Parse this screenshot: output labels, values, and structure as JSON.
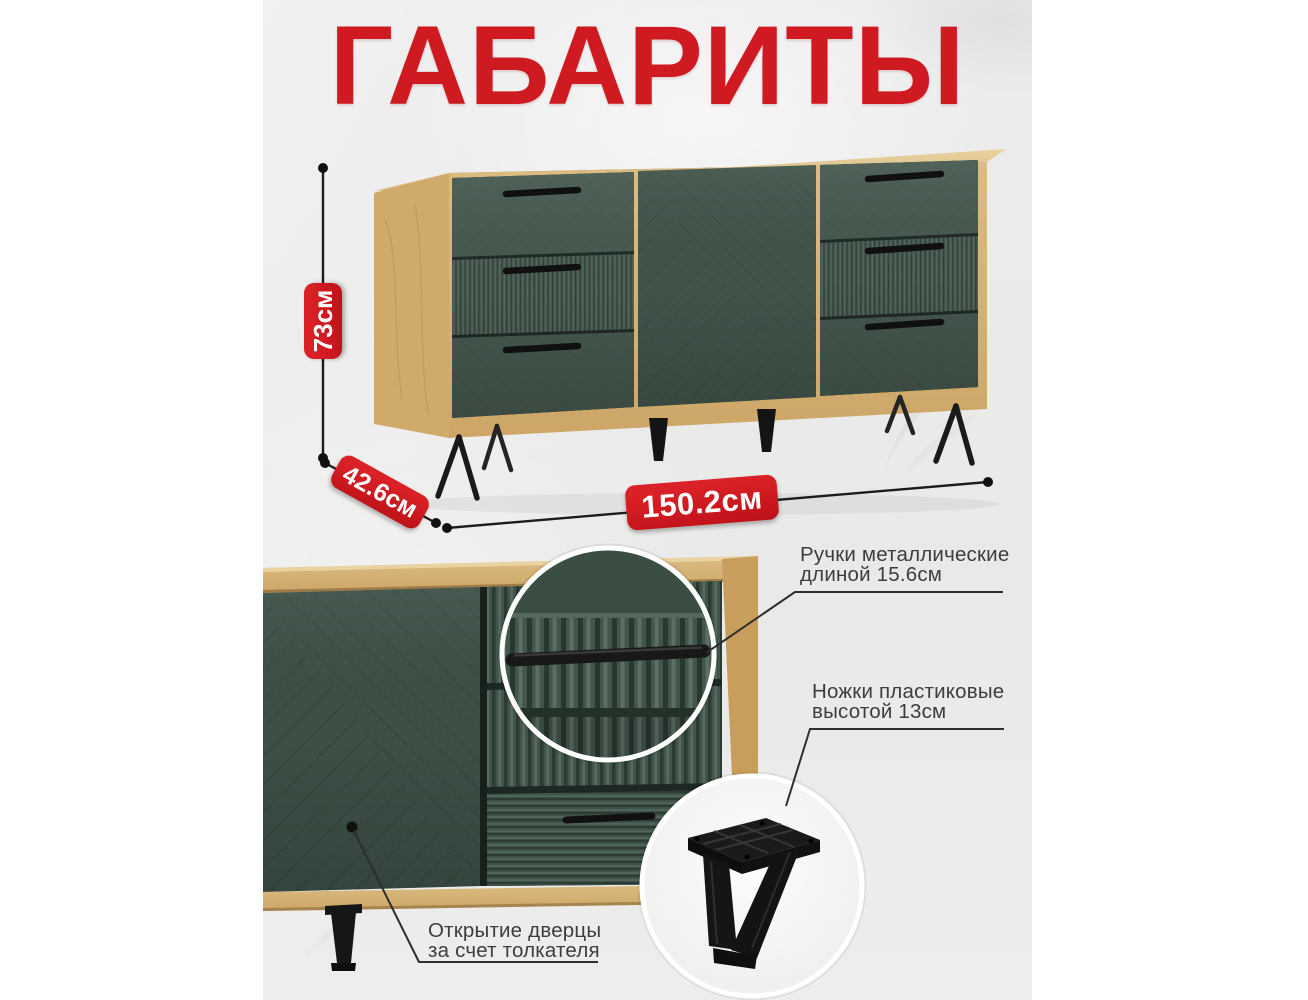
{
  "title": "ГАБАРИТЫ",
  "dimensions": {
    "height": "73см",
    "depth": "42.6см",
    "width": "150.2см"
  },
  "callouts": {
    "handles": {
      "line1": "Ручки металлические",
      "line2": "длиной 15.6см"
    },
    "legs": {
      "line1": "Ножки пластиковые",
      "line2": "высотой 13см"
    },
    "door": {
      "line1": "Открытие дверцы",
      "line2": "за счет толкателя"
    }
  },
  "colors": {
    "accent_red": "#ce1a20",
    "oak": "#d7b377",
    "oak_dark": "#c89e5c",
    "front_green": "#46594f",
    "green_dark": "#2f3f37",
    "background": "#ebebeb",
    "line": "#1f1f1f",
    "text": "#3d3d3d"
  }
}
